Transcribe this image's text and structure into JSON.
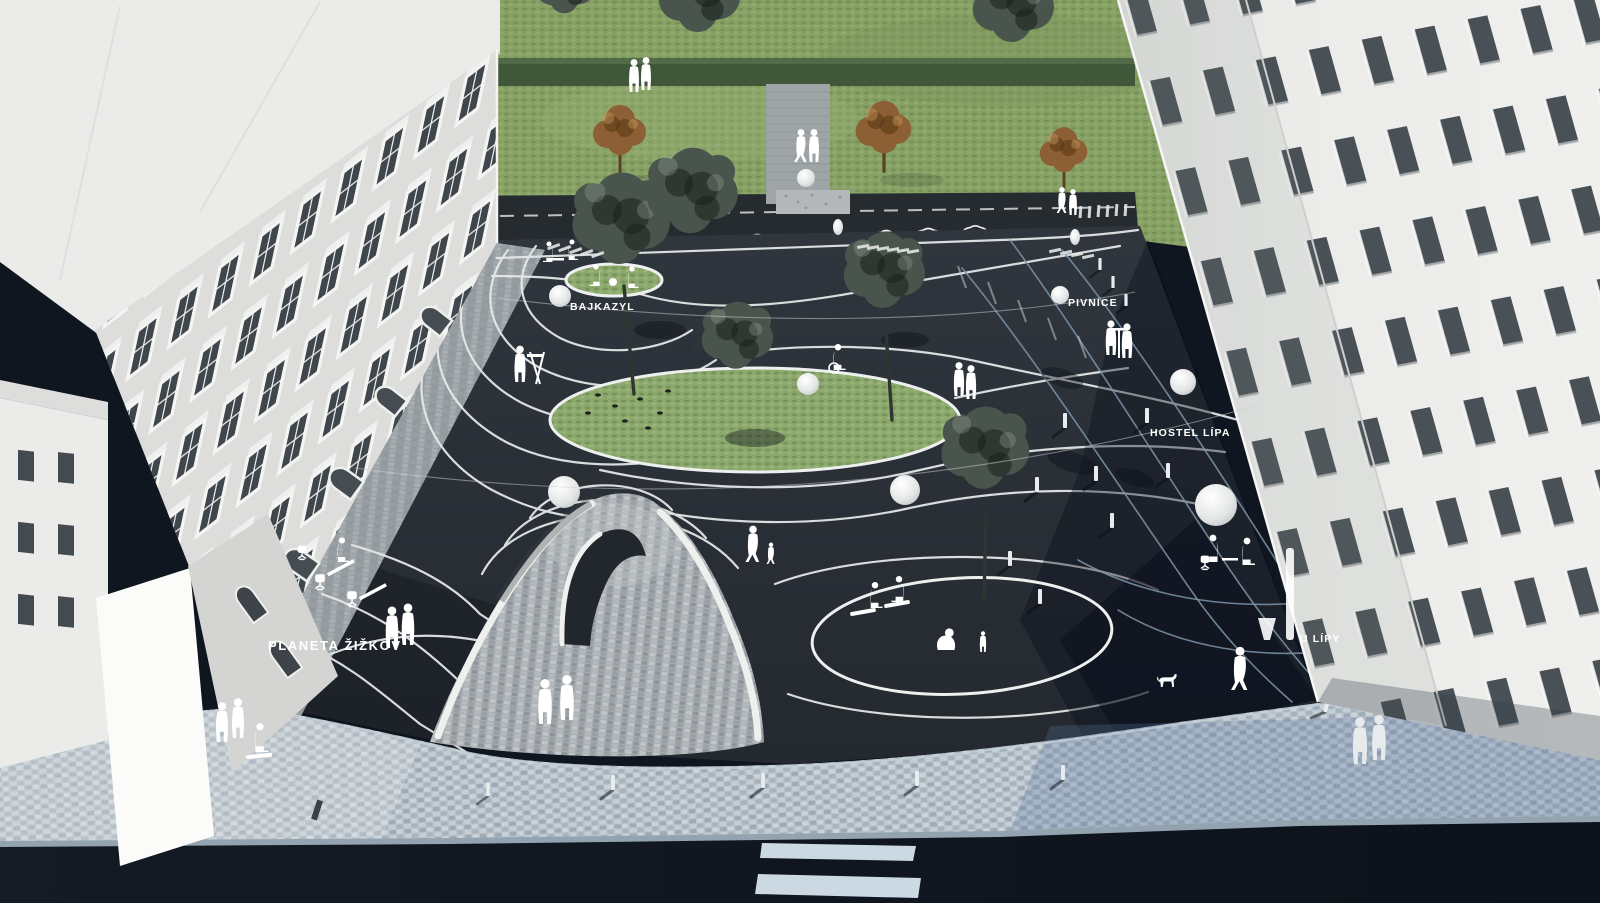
{
  "labels": {
    "planeta_zizkov": "PLANETA ŽIŽKOV",
    "bajkazyl": "BAJKAZYL",
    "pivnice": "PIVNICE",
    "hostel_lipa": "HOSTEL LÍPA",
    "u_lipy": "U LÍPY"
  },
  "colors": {
    "lawn": "#87a165",
    "hedge": "#40573a",
    "grass_oval": "#8ca96d",
    "tree_dark": "#49554c",
    "tree_brown": "#8d5f34",
    "plaza": "#2c3239",
    "plaza_shadow": "#0d1524",
    "contour": "#e8eaea",
    "contour_blue": "#7e95aa",
    "mound": "#a8adb1",
    "cobble": "#b7c2ca",
    "cobble_blue": "#94a9bd",
    "street_road": "#262b30",
    "street": "#0f151e",
    "curb": "#93a4b0",
    "crosswalk": "#ccd9e3",
    "building": "#ebecea",
    "building_bright": "#fbfbf9",
    "window": "#434a50",
    "monument": "#9fa5a7",
    "gravel": "#b4b8ba",
    "lamp": "#f2f3f2",
    "figure": "#ffffff"
  }
}
